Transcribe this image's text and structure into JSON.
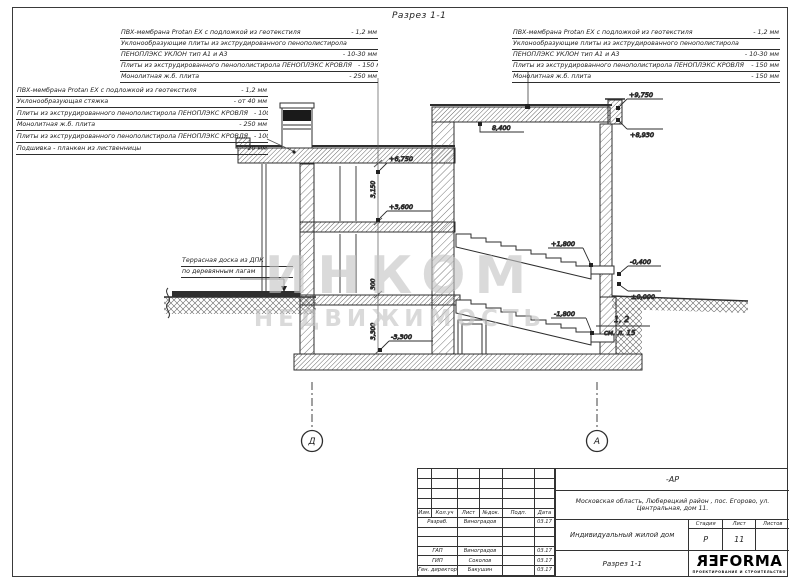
{
  "page": {
    "drawing_title": "Разрез 1-1"
  },
  "annotations": {
    "top_left": {
      "lines": [
        {
          "text": "ПВХ-мембрана Protan EX с подложкой из геотекстиля",
          "value": "- 1,2 мм"
        },
        {
          "text": "Уклонообразующие плиты из экструдированного пенополистирола",
          "value": ""
        },
        {
          "text": "ПЕНОПЛЭКС УКЛОН  тип А1 и А3",
          "value": "- 10-30 мм"
        },
        {
          "text": "Плиты из экструдированного пенополистирола ПЕНОПЛЭКС КРОВЛЯ",
          "value": "- 150 мм"
        },
        {
          "text": "Монолитная ж.б. плита",
          "value": "- 250 мм"
        }
      ]
    },
    "top_right": {
      "lines": [
        {
          "text": "ПВХ-мембрана Protan EX с подложкой из геотекстиля",
          "value": "- 1,2 мм"
        },
        {
          "text": "Уклонообразующие плиты из экструдированного пенополистирола",
          "value": ""
        },
        {
          "text": "ПЕНОПЛЭКС УКЛОН  тип А1 и А3",
          "value": "- 10-30 мм"
        },
        {
          "text": "Плиты из экструдированного пенополистирола ПЕНОПЛЭКС КРОВЛЯ",
          "value": "- 150 мм"
        },
        {
          "text": "Монолитная ж.б. плита",
          "value": "- 150 мм"
        }
      ]
    },
    "left_mid": {
      "lines": [
        {
          "text": "ПВХ-мембрана Protan EX с подложкой из геотекстиля",
          "value": "- 1,2 мм"
        },
        {
          "text": "Уклонообразующая стяжка",
          "value": "- от 40 мм"
        },
        {
          "text": "Плиты из экструдированного пенополистирола ПЕНОПЛЭКС КРОВЛЯ",
          "value": "- 100 мм"
        },
        {
          "text": "Монолитная ж.б. плита",
          "value": "- 250 мм"
        },
        {
          "text": "Плиты из экструдированного пенополистирола ПЕНОПЛЭКС КРОВЛЯ",
          "value": "- 100 мм"
        },
        {
          "text": "Подшивка - планкен из лиственницы",
          "value": "- 20 мм"
        }
      ]
    },
    "terrace_note": {
      "line1": "Террасная доска из ДПК",
      "line2": "по деревянным лагам"
    }
  },
  "marks": {
    "roof_left": "+6,750",
    "floor2": "+3,600",
    "basement_floor": "-3,300",
    "ceiling_right": "8,400",
    "parapet_top": "+9,750",
    "roof_top": "+8,930",
    "grade": "-0,400",
    "zero": "±0,000",
    "landing_up": "+1,800",
    "landing_down": "-1,800",
    "stair_ref_top": "1, 2",
    "stair_ref_bottom": "см. л. 15",
    "dim_floor2_h": "3,150",
    "dim_slab": "300",
    "dim_basement_h": "3,300",
    "axis_left": "Д",
    "axis_right": "А"
  },
  "watermark": {
    "line1": "ИНКОМ",
    "line2": "НЕДВИЖИМОСТЬ"
  },
  "titleblock": {
    "code": "-АР",
    "address": "Московская область, Люберецкий район , пос. Егорово, ул. Центральная, дом 11.",
    "object": "Индивидуальный жилой дом",
    "sheet_title": "Разрез 1-1",
    "stage_label": "Стадия",
    "sheet_label": "Лист",
    "sheets_label": "Листов",
    "stage": "Р",
    "sheet": "11",
    "sheets": "",
    "cols": [
      "Изм.",
      "Кол.уч",
      "Лист",
      "№док.",
      "Подп.",
      "Дата"
    ],
    "rows": [
      {
        "role": "Разраб.",
        "name": "Виноградов",
        "sign": "",
        "date": "03.17"
      },
      {
        "role": "",
        "name": "",
        "sign": "",
        "date": ""
      },
      {
        "role": "",
        "name": "",
        "sign": "",
        "date": ""
      },
      {
        "role": "ГАП",
        "name": "Виноградов",
        "sign": "",
        "date": "03.17"
      },
      {
        "role": "ГИП",
        "name": "Соколов",
        "sign": "",
        "date": "03.17"
      },
      {
        "role": "Ген. директор",
        "name": "Бакушин",
        "sign": "",
        "date": "03.17"
      }
    ],
    "logo": {
      "p1": "R",
      "p2": "E",
      "rest": "FORMA",
      "subtitle": "ПРОЕКТИРОВАНИЕ И СТРОИТЕЛЬСТВО"
    }
  }
}
